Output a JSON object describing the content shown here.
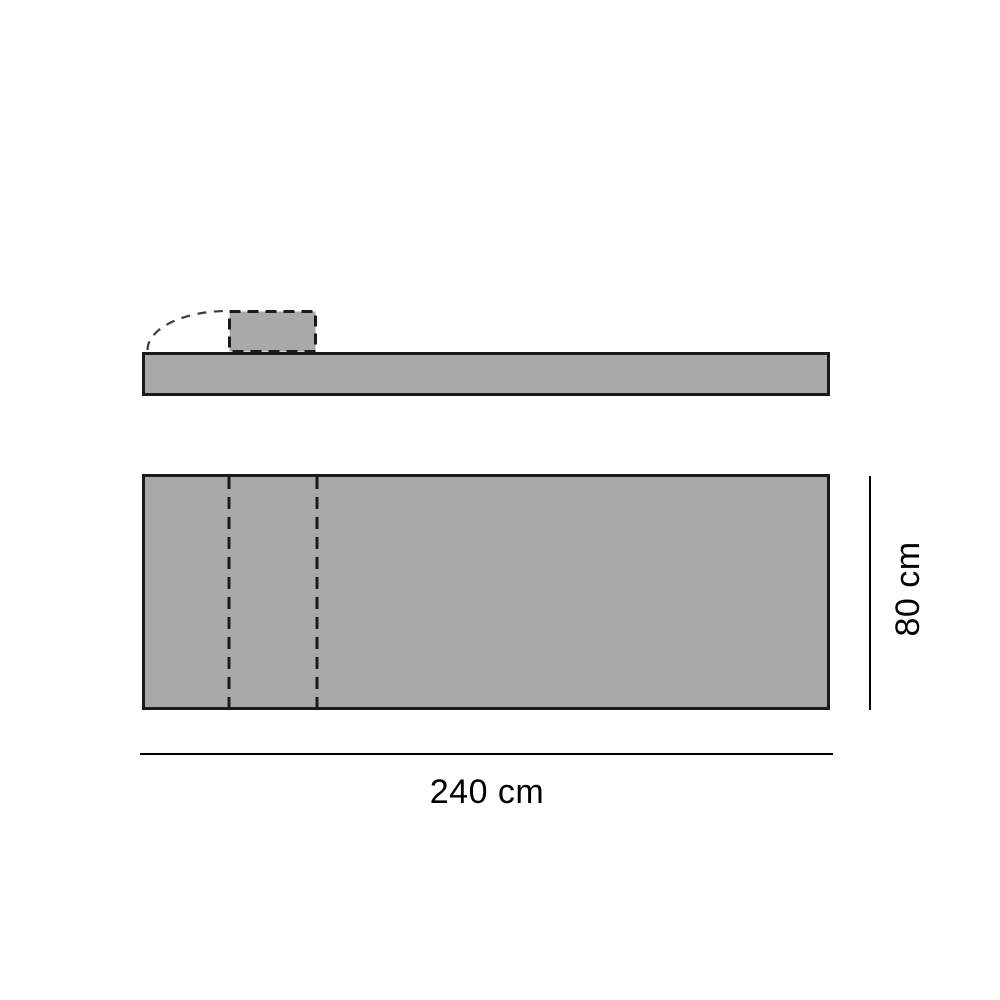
{
  "diagram": {
    "kind": "product dimension drawing, side view and top view of a rectangular panel with fold-over flap",
    "dimensions": {
      "width": {
        "value": 240,
        "unit": "cm",
        "label": "240 cm"
      },
      "height": {
        "value": 80,
        "unit": "cm",
        "label": "80 cm"
      }
    }
  },
  "colors": {
    "surface_fill": "#a9a9a9",
    "outline": "#1a1a1a",
    "fold_arc": "#3c3c3c",
    "dimension_line": "#000000",
    "text": "#000000",
    "background": "#ffffff"
  }
}
